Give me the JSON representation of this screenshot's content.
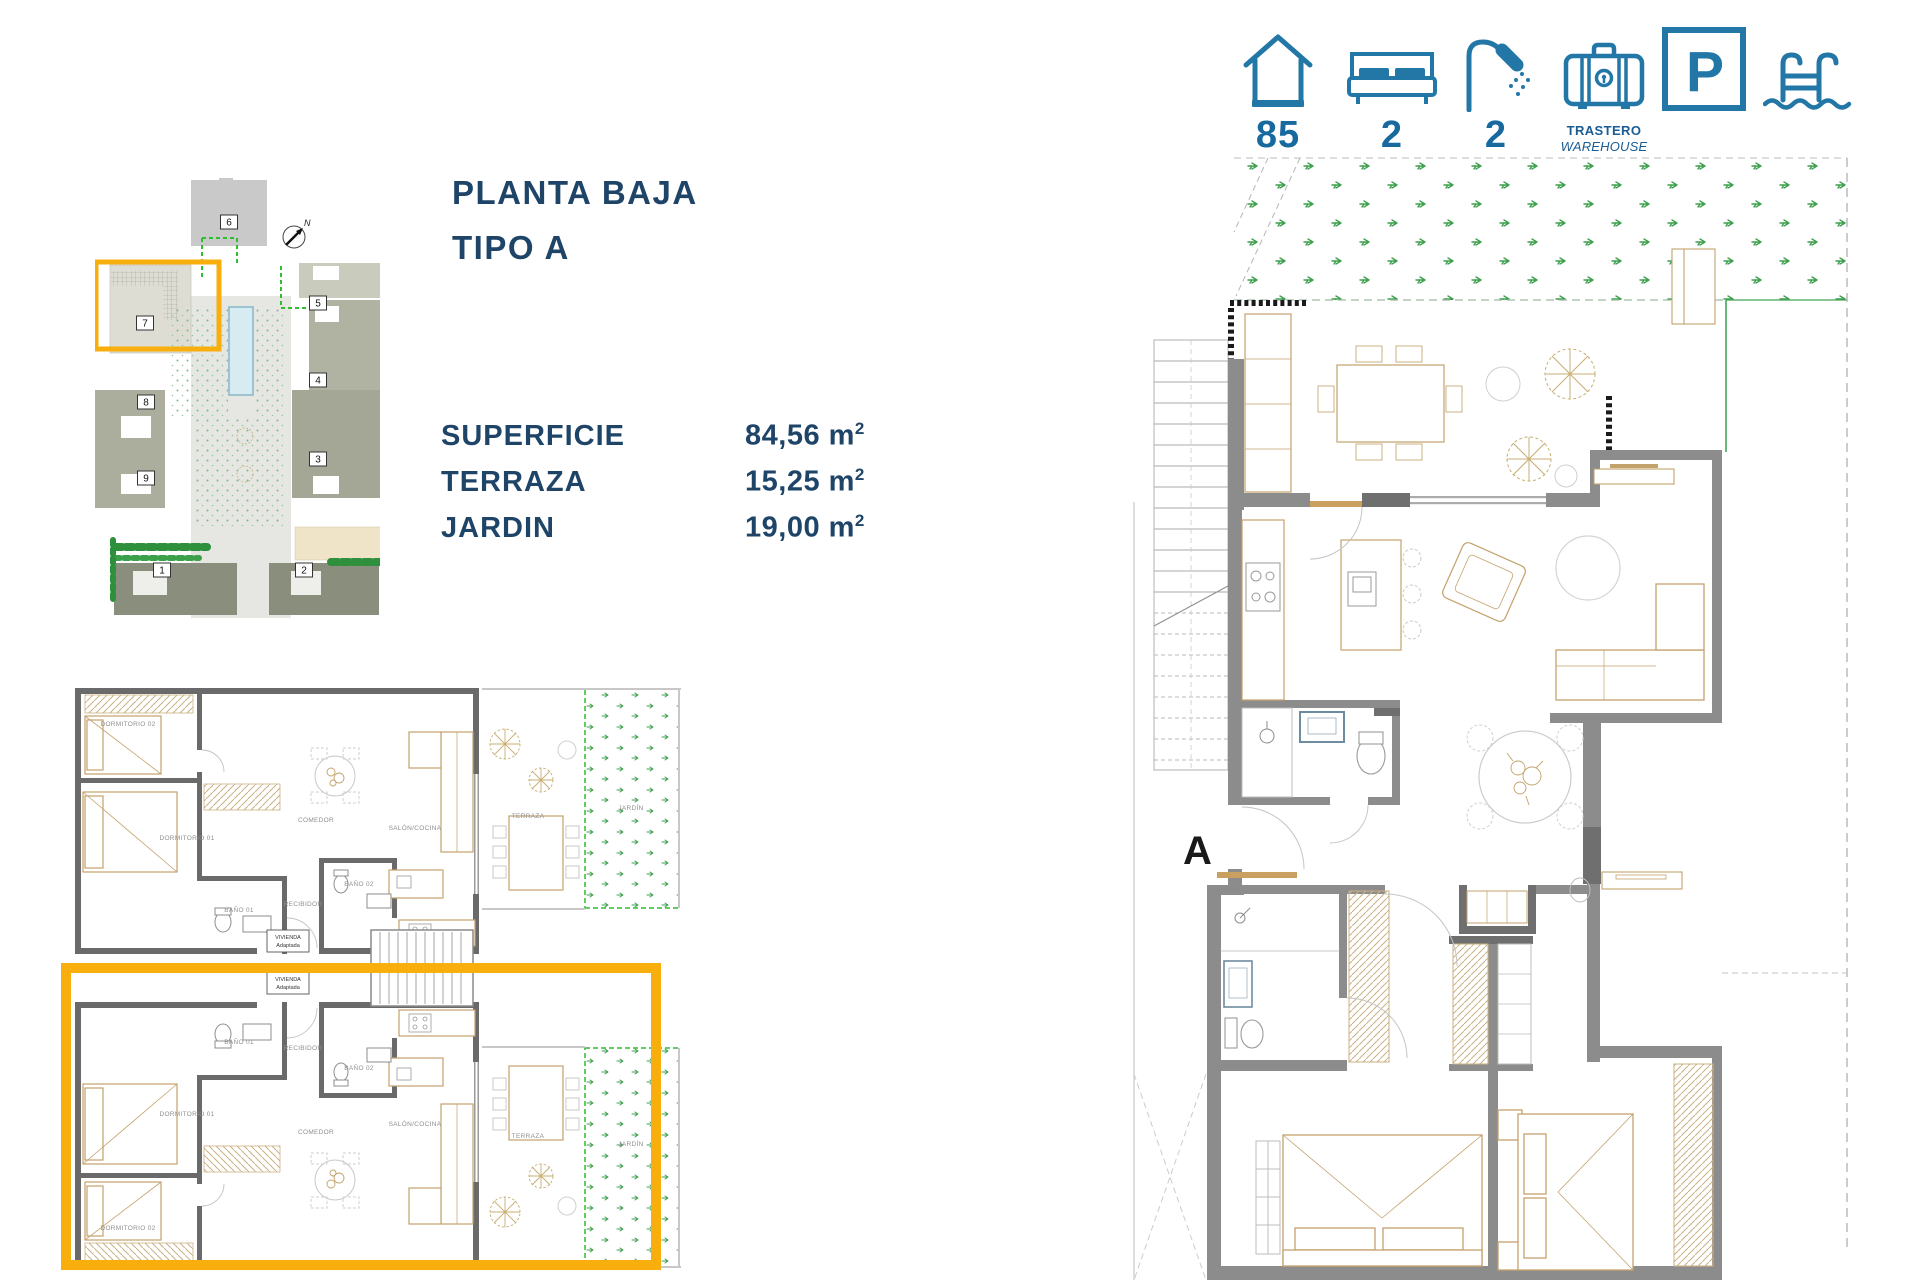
{
  "colors": {
    "accent_yellow": "#F8AE0D",
    "icon_blue": "#2277A7",
    "number_blue": "#17699E",
    "navy": "#1E4468",
    "wall_gray": "#8C8C8C",
    "furniture_tan": "#C3A26C",
    "garden_green": "#3D9F4C"
  },
  "amenity_bar": {
    "house": {
      "value": "85"
    },
    "bedrooms": {
      "value": "2"
    },
    "bathrooms": {
      "value": "2"
    },
    "warehouse": {
      "line1": "TRASTERO",
      "line2": "WAREHOUSE"
    },
    "parking": {
      "letter": "P"
    }
  },
  "title_block": {
    "line1": "PLANTA BAJA",
    "line2": "TIPO A"
  },
  "surface_table": {
    "rows": [
      {
        "label": "SUPERFICIE",
        "value": "84,56 m",
        "sup": "2"
      },
      {
        "label": "TERRAZA",
        "value": "15,25 m",
        "sup": "2"
      },
      {
        "label": "JARDIN",
        "value": "19,00 m",
        "sup": "2"
      }
    ]
  },
  "site_plan": {
    "compass_label": "N",
    "buildings": {
      "b1": "1",
      "b2": "2",
      "b3": "3",
      "b4": "4",
      "b5": "5",
      "b6": "6",
      "b7": "7",
      "b8": "8",
      "b9": "9"
    }
  },
  "small_plan": {
    "adapted_box": {
      "line1": "VIVIENDA",
      "line2": "Adaptada"
    },
    "upper": {
      "dorm2": "DORMITORIO 02",
      "dorm1": "DORMITORIO 01",
      "bano1": "BAÑO 01",
      "bano2": "BAÑO 02",
      "recibidor": "RECIBIDOR",
      "comedor": "COMEDOR",
      "salon": "SALÓN/COCINA",
      "terraza": "TERRAZA",
      "jardin": "JARDÍN"
    },
    "lower": {
      "dorm2": "DORMITORIO 02",
      "dorm1": "DORMITORIO 01",
      "bano1": "BAÑO 01",
      "bano2": "BAÑO 02",
      "recibidor": "RECIBIDOR",
      "comedor": "COMEDOR",
      "salon": "SALÓN/COCINA",
      "terraza": "TERRAZA",
      "jardin": "JARDÍN"
    }
  },
  "large_plan": {
    "unit_letter": "A"
  }
}
